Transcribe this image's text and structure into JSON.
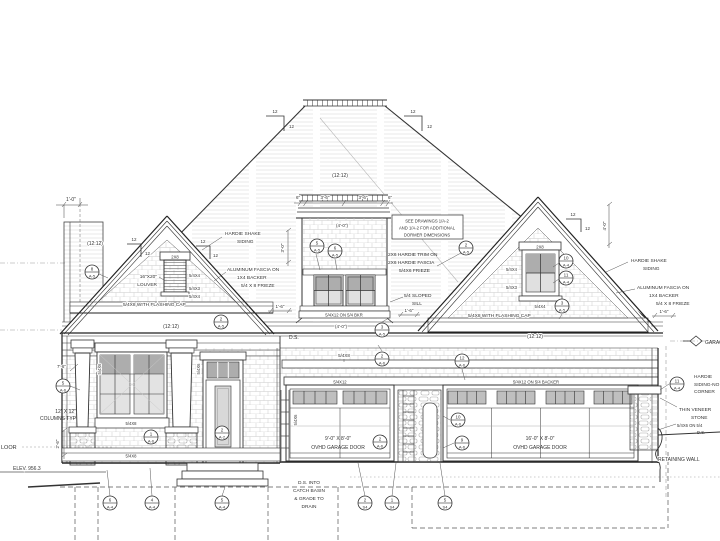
{
  "ann": {
    "dim_1_0": "1'-0\"",
    "dim_6in": "6\"",
    "dim_3_6": "3'-6\"",
    "dim_4_0_a": "(4'-0\")",
    "dim_4_0_b": "(4'-0\")",
    "dim_4_0_v": "4'-0\"",
    "dim_3_0_v": "3'-0\"",
    "dim_1_6": "1'-6\"",
    "dim_7_6": "7'-6\"",
    "dim_2_6_v": "2'-6\"",
    "pitch_12": "12",
    "slope_main": "(12:12)",
    "slope_left_upper": "(12:12)",
    "slope_left_lower": "(12:12)",
    "slope_right_lower": "(12:12)",
    "dormer_note_1": "SEE DRAWINGS 1/A-2",
    "dormer_note_2": "AND 1/A-2 FOR ADDITIONAL",
    "dormer_note_3": "DORMER DIMENSIONS",
    "trim_note_1": "2X6 HARDIE TRIM ON",
    "trim_note_2": "2X6 HARDIE FASCIA",
    "trim_note_3": "5/4X6 FRIEZE",
    "sill_1": "5/4 SLOPED",
    "sill_2": "SILL",
    "shake_1": "HARDIE SHAKE",
    "shake_2": "SIDING",
    "fascia_1": "ALUMINUM FASCIA ON",
    "fascia_2": "1X4 BACKER",
    "fascia_3": "5/4 X 8 FRIEZE",
    "flash_cap": "5/4X8 WITH FLASHING CAP",
    "louver_head": "2X8",
    "louver_size_1": "16\"X20\"",
    "louver_size_2": "LOUVER",
    "trim_5_4x4": "5/4X4",
    "trim_5_4x3": "5/4X3",
    "trim_5_4x6_v": "5/4X6",
    "win_head_2x8": "2X8",
    "dormer_band": "5/4X12 ON 5/4 BKR",
    "band_5_4x8": "5/4X8",
    "band_5_4x12": "5/4X12",
    "band_backer": "5/4X12 ON 5/4 BACKER",
    "ds": "D.S.",
    "gd_left_1": "9'-0\" X 8'-0\"",
    "gd_left_2": "OVHD GARAGE DOOR",
    "gd_right_1": "16'-0\" X 8'-0\"",
    "gd_right_2": "OVHD GARAGE DOOR",
    "col_note_1": "12\" X 12\"",
    "col_note_2": "COLUMNS TYP",
    "floor_frag": "LOOR",
    "elev_label": "ELEV. 956.3",
    "ds_note_1": "D.S. INTO",
    "ds_note_2": "CATCH BASIN",
    "ds_note_3": "& GRADE TO",
    "ds_note_4": "DRAIN",
    "corner_1": "HARDIE",
    "corner_2": "SIDING-NO",
    "corner_3": "CORNER",
    "stone_1": "THIN VENEER",
    "stone_2": "STONE",
    "stone_3": "5/4X6 ON 5/4",
    "retaining": "RETAINING WALL",
    "garage_marker": "GARAGE"
  },
  "callouts": [
    {
      "n": "8",
      "s": "A-5"
    },
    {
      "n": "2",
      "s": "A-5"
    },
    {
      "n": "5",
      "s": "A-5"
    },
    {
      "n": "6",
      "s": "A-5"
    },
    {
      "n": "2",
      "s": "A-5"
    },
    {
      "n": "10",
      "s": "A-4"
    },
    {
      "n": "11",
      "s": "A-4"
    },
    {
      "n": "3",
      "s": "A-5"
    },
    {
      "n": "3",
      "s": "A-5"
    },
    {
      "n": "2",
      "s": "A-6"
    },
    {
      "n": "12",
      "s": "A-6"
    },
    {
      "n": "2",
      "s": "A-6"
    },
    {
      "n": "10",
      "s": "A-6"
    },
    {
      "n": "9",
      "s": "A-6"
    },
    {
      "n": "1",
      "s": "A-6"
    },
    {
      "n": "2",
      "s": "A-2"
    },
    {
      "n": "5",
      "s": "A-6"
    },
    {
      "n": "11",
      "s": "A-4"
    },
    {
      "n": "6",
      "s": "A-4"
    },
    {
      "n": "4",
      "s": "A-4"
    },
    {
      "n": "5",
      "s": "A-4"
    },
    {
      "n": "2",
      "s": "S4"
    },
    {
      "n": "1",
      "s": "S4"
    },
    {
      "n": "5",
      "s": "S4"
    }
  ]
}
